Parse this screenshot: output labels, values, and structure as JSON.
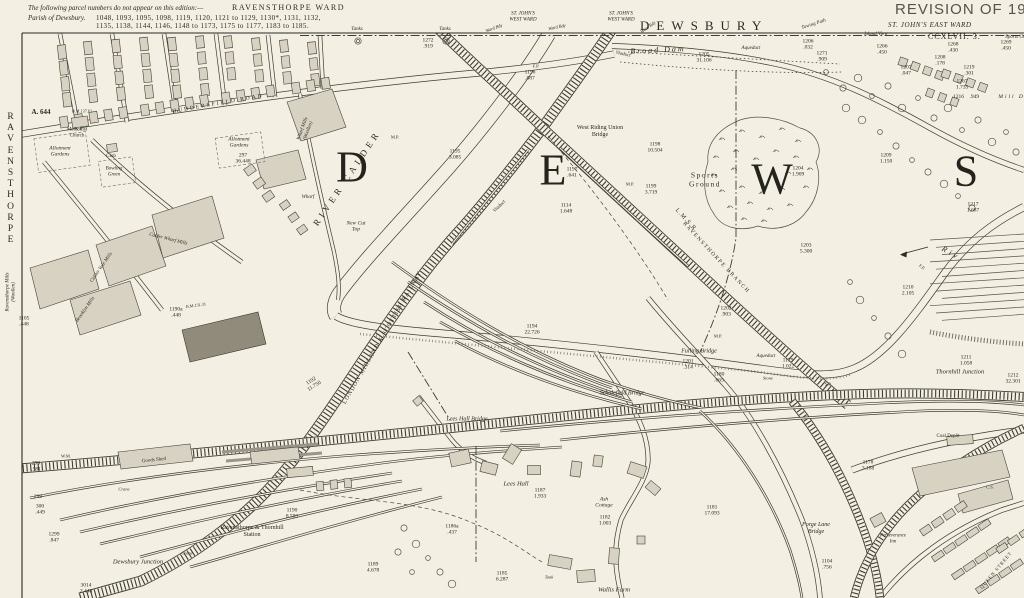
{
  "edition_note": {
    "line1": "The following parcel numbers do not appear on this edition:—",
    "ward": "RAVENSTHORPE WARD",
    "line2_prefix": "Parish of Dewsbury.",
    "line2_numbers": "1048, 1093, 1095, 1098, 1119, 1120, 1121 to 1129, 1130*, 1131, 1132,",
    "line3_numbers": "1135, 1138, 1144, 1146, 1148 to 1173, 1175 to 1177, 1183 to 1185."
  },
  "margins": {
    "top_center_title": "DEWSBURY",
    "revision_stamp": "REVISION OF 19",
    "east_ward": "ST. JOHN'S EAST WARD",
    "sheet_number": "CCXLVII. 3.",
    "left_vertical": "RAVENSTHORPE"
  },
  "colors": {
    "paper": "#f3efe2",
    "ink": "#2b2a24",
    "building": "#d7d2c2",
    "building_dark": "#908b7b"
  },
  "map_labels": [
    {
      "t": "D",
      "x": 352,
      "y": 168,
      "s": 44,
      "st": "big",
      "n": "place-letter-d"
    },
    {
      "t": "E",
      "x": 553,
      "y": 171,
      "s": 44,
      "st": "big",
      "n": "place-letter-e"
    },
    {
      "t": "W",
      "x": 772,
      "y": 180,
      "s": 44,
      "st": "big",
      "n": "place-letter-w"
    },
    {
      "t": "S",
      "x": 966,
      "y": 172,
      "s": 44,
      "st": "big",
      "n": "place-letter-s"
    },
    {
      "t": "RIVER CALDER",
      "x": 347,
      "y": 178,
      "s": 9,
      "r": -56,
      "ls": 4,
      "n": "river-calder-label"
    },
    {
      "t": "Broad Dam",
      "x": 658,
      "y": 50,
      "s": 8,
      "r": -3,
      "st": "i",
      "ls": 2
    },
    {
      "t": "West Riding Union\nBridge",
      "x": 600,
      "y": 132,
      "s": 6,
      "n": "bridge-label"
    },
    {
      "t": "Viaduct",
      "x": 623,
      "y": 55,
      "s": 5,
      "r": 12,
      "st": "i"
    },
    {
      "t": "Viaduct",
      "x": 500,
      "y": 207,
      "s": 5,
      "r": -44,
      "st": "i"
    },
    {
      "t": "Sports\nGround",
      "x": 705,
      "y": 180,
      "s": 7.5,
      "ls": 1.5,
      "n": "sports-ground-label"
    },
    {
      "t": "1204\n1.909",
      "x": 798,
      "y": 172,
      "s": 5.5
    },
    {
      "t": "1196\n.887",
      "x": 530,
      "y": 76,
      "s": 5.5
    },
    {
      "t": "1272\n.919",
      "x": 428,
      "y": 44,
      "s": 5.5
    },
    {
      "t": "1195\n3.085",
      "x": 455,
      "y": 155,
      "s": 5.5
    },
    {
      "t": "1197\n.641",
      "x": 572,
      "y": 173,
      "s": 5.5
    },
    {
      "t": "1114\n1.648",
      "x": 566,
      "y": 209,
      "s": 5.5
    },
    {
      "t": "1198\n10.504",
      "x": 655,
      "y": 148,
      "s": 5.5
    },
    {
      "t": "M.P.",
      "x": 630,
      "y": 184,
      "s": 4.5
    },
    {
      "t": "1199\n3.719",
      "x": 651,
      "y": 190,
      "s": 5.5
    },
    {
      "t": "1203\n5.300",
      "x": 806,
      "y": 249,
      "s": 5.5
    },
    {
      "t": "1202\n.903",
      "x": 726,
      "y": 312,
      "s": 5.5
    },
    {
      "t": "1194\n22.726",
      "x": 532,
      "y": 330,
      "s": 5.5
    },
    {
      "t": "1192\n11.750",
      "x": 313,
      "y": 384,
      "s": 5.5,
      "r": -32
    },
    {
      "t": "1201\n.314",
      "x": 688,
      "y": 365,
      "s": 5.5
    },
    {
      "t": "1179\n1.022",
      "x": 788,
      "y": 364,
      "s": 5.5
    },
    {
      "t": "1180\n.665",
      "x": 719,
      "y": 378,
      "s": 5.5
    },
    {
      "t": "1211\n1.058",
      "x": 966,
      "y": 361,
      "s": 5.5
    },
    {
      "t": "1212\n32.301",
      "x": 1013,
      "y": 379,
      "s": 5.5
    },
    {
      "t": "1217\n1.687",
      "x": 973,
      "y": 208,
      "s": 5.5
    },
    {
      "t": "1209\n1.150",
      "x": 886,
      "y": 159,
      "s": 5.5
    },
    {
      "t": "1210\n2.105",
      "x": 908,
      "y": 291,
      "s": 5.5
    },
    {
      "t": "1216    .949",
      "x": 966,
      "y": 97,
      "s": 5.5
    },
    {
      "t": "Mill Dam",
      "x": 1017,
      "y": 97,
      "s": 5.5,
      "st": "i",
      "ls": 2
    },
    {
      "t": "1267\n1.735",
      "x": 962,
      "y": 85,
      "s": 5.5
    },
    {
      "t": "1219\n.301",
      "x": 969,
      "y": 71,
      "s": 5.5
    },
    {
      "t": "1208\n.178",
      "x": 940,
      "y": 61,
      "s": 5.5
    },
    {
      "t": "1207\n.047",
      "x": 906,
      "y": 71,
      "s": 5.5
    },
    {
      "t": "1268\n.430",
      "x": 953,
      "y": 48,
      "s": 5.5
    },
    {
      "t": "1269\n.450",
      "x": 1006,
      "y": 46,
      "s": 5.5
    },
    {
      "t": "1266\n.450",
      "x": 882,
      "y": 50,
      "s": 5.5
    },
    {
      "t": "1206\n.032",
      "x": 808,
      "y": 45,
      "s": 5.5
    },
    {
      "t": "1271\n.909",
      "x": 822,
      "y": 57,
      "s": 5.5
    },
    {
      "t": "1205\n31.106",
      "x": 704,
      "y": 58,
      "s": 5.5
    },
    {
      "t": "297\n36.448",
      "x": 243,
      "y": 159,
      "s": 5.5
    },
    {
      "t": "Allotment\nGardens",
      "x": 239,
      "y": 143,
      "s": 5.5,
      "st": "i"
    },
    {
      "t": "Allotment\nGardens",
      "x": 60,
      "y": 152,
      "s": 5.5,
      "st": "i"
    },
    {
      "t": "299\n.581",
      "x": 36,
      "y": 467,
      "s": 5.5
    },
    {
      "t": "299",
      "x": 38,
      "y": 497,
      "s": 5.5
    },
    {
      "t": "300\n.449",
      "x": 40,
      "y": 510,
      "s": 5.5
    },
    {
      "t": "1299\n.847",
      "x": 54,
      "y": 538,
      "s": 5.5
    },
    {
      "t": "3014\n2.448",
      "x": 86,
      "y": 589,
      "s": 5.5
    },
    {
      "t": "1105\n.448",
      "x": 24,
      "y": 322,
      "s": 5.5
    },
    {
      "t": "1190a\n.448",
      "x": 176,
      "y": 313,
      "s": 5.5
    },
    {
      "t": "1187\n1.933",
      "x": 540,
      "y": 494,
      "s": 5.5
    },
    {
      "t": "1186a\n.437",
      "x": 452,
      "y": 530,
      "s": 5.5
    },
    {
      "t": "1185\n6.287",
      "x": 502,
      "y": 577,
      "s": 5.5
    },
    {
      "t": "Ash\nCottage",
      "x": 604,
      "y": 503,
      "s": 5.5,
      "st": "i"
    },
    {
      "t": "1182\n1.003",
      "x": 605,
      "y": 521,
      "s": 5.5
    },
    {
      "t": "1189\n4.678",
      "x": 373,
      "y": 568,
      "s": 5.5
    },
    {
      "t": "1190\n8.593",
      "x": 292,
      "y": 514,
      "s": 5.5
    },
    {
      "t": "1181\n17.093",
      "x": 712,
      "y": 511,
      "s": 5.5
    },
    {
      "t": "1178\n3.188",
      "x": 868,
      "y": 466,
      "s": 5.5
    },
    {
      "t": "1104\n.756",
      "x": 827,
      "y": 565,
      "s": 5.5
    },
    {
      "t": "Fulling Bridge",
      "x": 699,
      "y": 352,
      "s": 6,
      "st": "i",
      "n": "bridge-label"
    },
    {
      "t": "Aqueduct",
      "x": 766,
      "y": 357,
      "s": 5,
      "st": "i"
    },
    {
      "t": "Aqueduct",
      "x": 751,
      "y": 49,
      "s": 5,
      "st": "i"
    },
    {
      "t": "Thornhill Junction",
      "x": 960,
      "y": 372,
      "s": 6.5,
      "st": "i",
      "n": "junction-label"
    },
    {
      "t": "Scholefield Bridge",
      "x": 622,
      "y": 394,
      "s": 6,
      "st": "i",
      "n": "bridge-label"
    },
    {
      "t": "Lees Hall Bridge",
      "x": 467,
      "y": 420,
      "s": 6,
      "st": "i",
      "n": "bridge-label"
    },
    {
      "t": "Lees Hall",
      "x": 516,
      "y": 484,
      "s": 6.5,
      "st": "i"
    },
    {
      "t": "Wallis Farm",
      "x": 614,
      "y": 590,
      "s": 6.5,
      "st": "i"
    },
    {
      "t": "Tank",
      "x": 549,
      "y": 577,
      "s": 4.5,
      "st": "i"
    },
    {
      "t": "Ravensthorpe & Thornhill\nStation",
      "x": 252,
      "y": 532,
      "s": 6,
      "n": "station-label"
    },
    {
      "t": "Dewsbury Junction",
      "x": 138,
      "y": 562,
      "s": 6.5,
      "st": "i",
      "n": "junction-label"
    },
    {
      "t": "Goods Shed",
      "x": 154,
      "y": 461,
      "s": 5,
      "r": -6
    },
    {
      "t": "Crane",
      "x": 124,
      "y": 489,
      "s": 4.5,
      "st": "i"
    },
    {
      "t": "Crane",
      "x": 187,
      "y": 553,
      "s": 4.5,
      "st": "i"
    },
    {
      "t": "W.M.",
      "x": 66,
      "y": 456,
      "s": 4.5
    },
    {
      "t": "Coal Depôt",
      "x": 948,
      "y": 437,
      "s": 5
    },
    {
      "t": "Perseverance\nInn",
      "x": 893,
      "y": 539,
      "s": 4.8,
      "st": "i"
    },
    {
      "t": "Forge Lane\nBridge",
      "x": 816,
      "y": 529,
      "s": 6,
      "st": "i",
      "n": "bridge-label"
    },
    {
      "t": "QUEEN STREET",
      "x": 997,
      "y": 571,
      "s": 4.8,
      "r": -50,
      "ls": 1,
      "n": "street-label"
    },
    {
      "t": "C.S.",
      "x": 990,
      "y": 487,
      "s": 4.5
    },
    {
      "t": "HUDDERSFIELD ROAD",
      "x": 218,
      "y": 104,
      "s": 5.5,
      "r": -10,
      "ls": 2,
      "n": "street-label"
    },
    {
      "t": "A. 644",
      "x": 41,
      "y": 112,
      "s": 7,
      "b": 1
    },
    {
      "t": "B.M.137.61",
      "x": 82,
      "y": 112,
      "s": 4.2
    },
    {
      "t": "Methodist\nChurch",
      "x": 77,
      "y": 133,
      "s": 5
    },
    {
      "t": "Club",
      "x": 111,
      "y": 157,
      "s": 5
    },
    {
      "t": "Bowling\nGreen",
      "x": 114,
      "y": 172,
      "s": 5,
      "st": "i"
    },
    {
      "t": "Calder Wharf Mills",
      "x": 168,
      "y": 240,
      "s": 5,
      "st": "i",
      "r": 14
    },
    {
      "t": "Wharf Mills\n(Woollen)",
      "x": 306,
      "y": 130,
      "s": 5,
      "st": "i",
      "r": -70
    },
    {
      "t": "Ravensthorpe Mills\n(Woollen)",
      "x": 11,
      "y": 292,
      "s": 5,
      "st": "i",
      "r": -90
    },
    {
      "t": "Calder Vale Mills",
      "x": 102,
      "y": 268,
      "s": 5,
      "st": "i",
      "r": -55
    },
    {
      "t": "Brooklyn Mills",
      "x": 86,
      "y": 310,
      "s": 5,
      "st": "i",
      "r": -55
    },
    {
      "t": "Wharf",
      "x": 308,
      "y": 198,
      "s": 5,
      "st": "i"
    },
    {
      "t": "New Cut\nTop",
      "x": 356,
      "y": 227,
      "s": 5.5,
      "st": "i"
    },
    {
      "t": "L.M.S.R.",
      "x": 686,
      "y": 221,
      "s": 6,
      "r": 47,
      "ls": 1,
      "n": "railway-label"
    },
    {
      "t": "RAVENSTHORPE BRANCH",
      "x": 716,
      "y": 258,
      "s": 5.5,
      "r": 47,
      "ls": 1.5,
      "n": "railway-label"
    },
    {
      "t": "LONDON MIDLAND & SCOTTISH RAILWAY",
      "x": 383,
      "y": 338,
      "s": 6,
      "r": -60,
      "ls": 1,
      "n": "railway-label"
    },
    {
      "t": "Riv",
      "x": 951,
      "y": 253,
      "s": 8,
      "st": "i",
      "r": 30,
      "ls": 3,
      "n": "river-label"
    },
    {
      "t": "M.P.",
      "x": 395,
      "y": 137,
      "s": 4.5
    },
    {
      "t": "M.P.",
      "x": 718,
      "y": 336,
      "s": 4.5
    },
    {
      "t": "S.P.",
      "x": 828,
      "y": 384,
      "s": 4.5
    },
    {
      "t": "Stone",
      "x": 768,
      "y": 378,
      "s": 4.5,
      "st": "i"
    },
    {
      "t": "B.M.131.31",
      "x": 196,
      "y": 306,
      "s": 4.2,
      "r": -8
    },
    {
      "t": "Towing Path",
      "x": 814,
      "y": 25,
      "s": 5,
      "st": "i",
      "r": -18
    },
    {
      "t": "Island View",
      "x": 876,
      "y": 35,
      "s": 5,
      "st": "i"
    },
    {
      "t": "Sports Ground",
      "x": 1020,
      "y": 38,
      "s": 5,
      "st": "i"
    },
    {
      "t": "ST. JOHN'S\nWEST WARD",
      "x": 523,
      "y": 17,
      "s": 5,
      "st": "i"
    },
    {
      "t": "ST. JOHN'S\nWEST WARD",
      "x": 621,
      "y": 17,
      "s": 5,
      "st": "i"
    },
    {
      "t": "Ward Bdy",
      "x": 494,
      "y": 28,
      "s": 4.5,
      "st": "i",
      "r": -20
    },
    {
      "t": "Ward Bdy",
      "x": 557,
      "y": 27,
      "s": 4.5,
      "st": "i",
      "r": -12
    },
    {
      "t": "Ward Bdy",
      "x": 648,
      "y": 27,
      "s": 4.5,
      "st": "i",
      "r": -35
    },
    {
      "t": "Tanks",
      "x": 357,
      "y": 30,
      "s": 5,
      "st": "i"
    },
    {
      "t": "Tanks",
      "x": 445,
      "y": 30,
      "s": 5,
      "st": "i"
    },
    {
      "t": "F.P.",
      "x": 536,
      "y": 66,
      "s": 4.5
    },
    {
      "t": "F.P.",
      "x": 922,
      "y": 267,
      "s": 4.5,
      "r": 40
    }
  ]
}
